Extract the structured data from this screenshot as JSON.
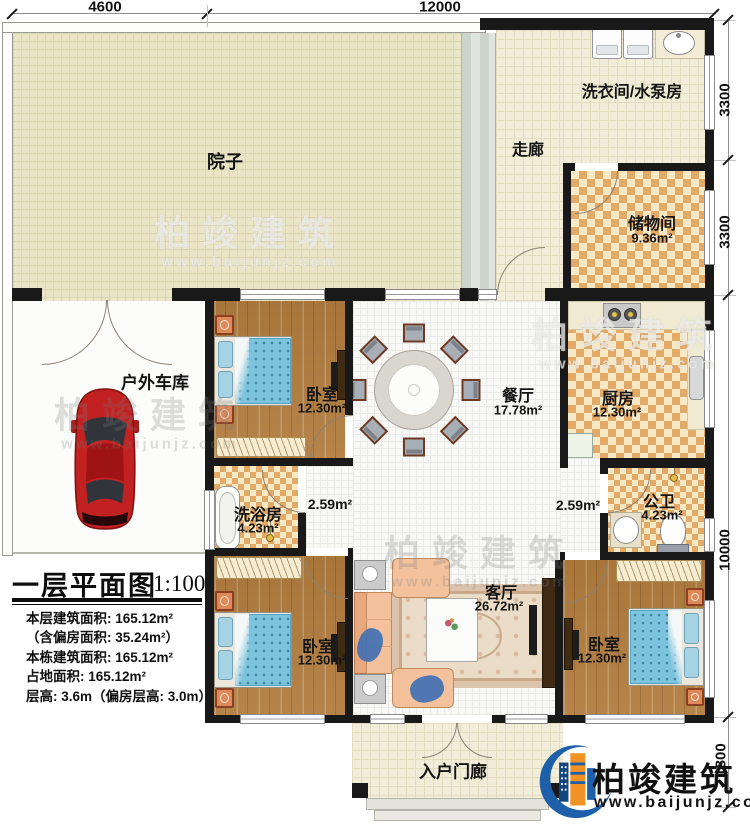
{
  "dimensions": {
    "top": [
      "4600",
      "12000"
    ],
    "right": [
      "3300",
      "3300",
      "10000",
      "1800"
    ]
  },
  "rooms": {
    "courtyard": {
      "label": "院子"
    },
    "corridor": {
      "label": "走廊"
    },
    "laundry": {
      "label": "洗衣间/水泵房"
    },
    "storage": {
      "label": "储物间",
      "area": "9.36m²"
    },
    "bedroom_top": {
      "label": "卧室",
      "area": "12.30m²"
    },
    "dining": {
      "label": "餐厅",
      "area": "17.78m²"
    },
    "kitchen": {
      "label": "厨房",
      "area": "12.30m²"
    },
    "garage": {
      "label": "户外车库"
    },
    "shower": {
      "label": "洗浴房",
      "area": "4.23m²"
    },
    "hall_left": {
      "area": "2.59m²"
    },
    "hall_right": {
      "area": "2.59m²"
    },
    "toilet": {
      "label": "公卫",
      "area": "4.23m²"
    },
    "living": {
      "label": "客厅",
      "area": "26.72m²"
    },
    "bedroom_left": {
      "label": "卧室",
      "area": "12.30m²"
    },
    "bedroom_right": {
      "label": "卧室",
      "area": "12.30m²"
    },
    "porch": {
      "label": "入户门廊"
    }
  },
  "title_block": {
    "title": "一层平面图",
    "scale": "1:100",
    "stats": [
      "本层建筑面积: 165.12m²",
      "（含偏房面积: 35.24m²）",
      "本栋建筑面积: 165.12m²",
      "占地面积: 165.12m²",
      "层高: 3.6m（偏房层高: 3.0m）"
    ]
  },
  "branding": {
    "brand": "柏竣建筑",
    "url": "www.baijunjz.com"
  },
  "colors": {
    "accent_blue": "#1d5fa8",
    "accent_orange": "#f29224",
    "wall": "#191919",
    "checker": "#e2a967",
    "wood": "#b17c3e",
    "courtyard": "#ebe5c8",
    "bed_blue": "#7cc3dd"
  }
}
